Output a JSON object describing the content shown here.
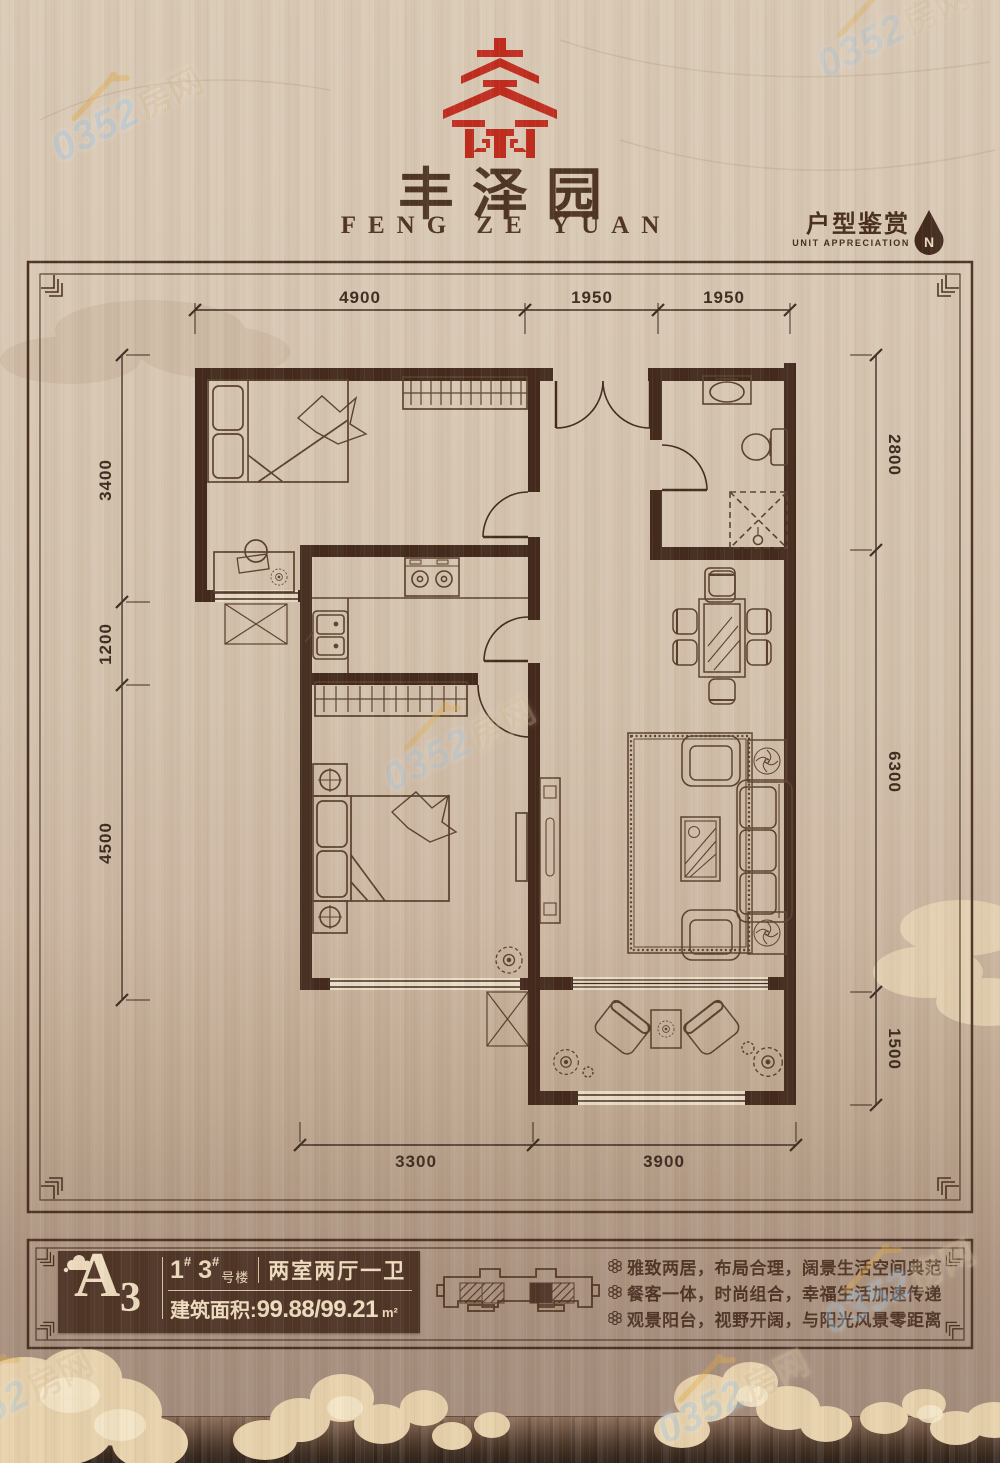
{
  "brand": {
    "cn": "丰泽园",
    "en": "FENG ZE YUAN"
  },
  "header": {
    "title_cn": "户型鉴赏",
    "title_en": "UNIT APPRECIATION",
    "compass": "N"
  },
  "plan": {
    "dims": {
      "top": [
        "4900",
        "1950",
        "1950"
      ],
      "left": [
        "3400",
        "1200",
        "4500"
      ],
      "right": [
        "2800",
        "6300",
        "1500"
      ],
      "bottom": [
        "3300",
        "3900"
      ]
    }
  },
  "info": {
    "unit_letter": "A",
    "unit_number": "3",
    "bldg_num_1": "1",
    "bldg_num_2": "3",
    "hash": "#",
    "bldg_suffix": "号楼",
    "layout": "两室两厅一卫",
    "area_label": "建筑面积:",
    "area_value": "99.88/99.21",
    "area_unit": "m²"
  },
  "features": [
    "雅致两居，布局合理，阔景生活空间典范",
    "餐客一体，时尚组合，幸福生活加速传递",
    "观景阳台，视野开阔，与阳光风景零距离"
  ],
  "watermark": {
    "number": "0352",
    "cn": "房网"
  },
  "colors": {
    "wall": "#42291c",
    "seal_red": "#c02b1d",
    "panel_brown": "#4f3526",
    "cream": "#eddcbf"
  }
}
